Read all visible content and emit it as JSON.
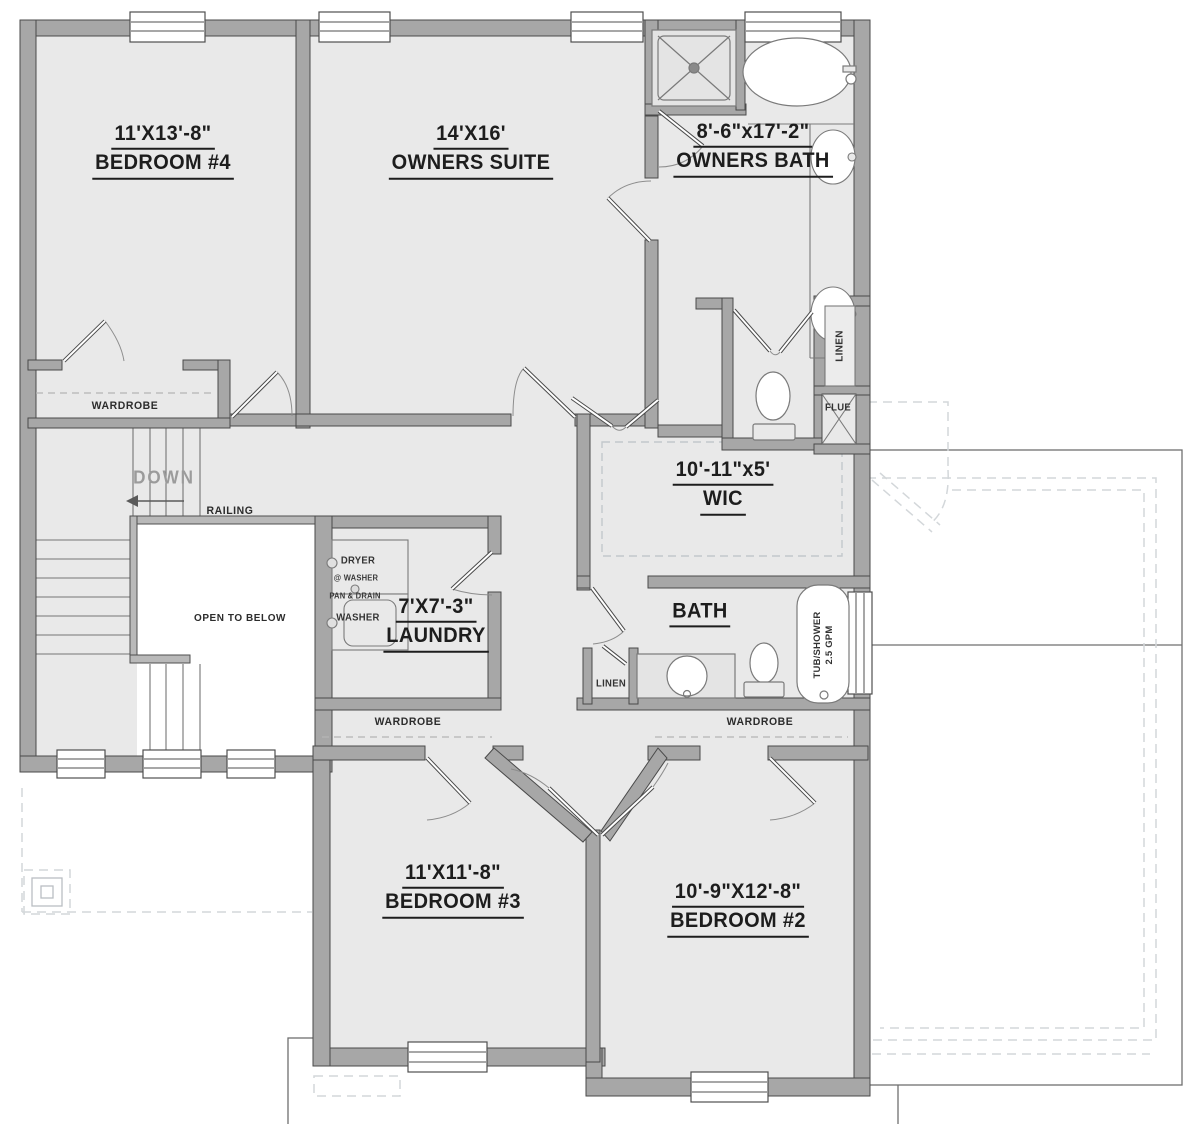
{
  "rooms": {
    "bedroom4": {
      "dims": "11'X13'-8\"",
      "name": "BEDROOM #4"
    },
    "owners_suite": {
      "dims": "14'X16'",
      "name": "OWNERS SUITE"
    },
    "owners_bath": {
      "dims": "8'-6\"x17'-2\"",
      "name": "OWNERS BATH"
    },
    "wic": {
      "dims": "10'-11\"x5'",
      "name": "WIC"
    },
    "laundry": {
      "dims": "7'X7'-3\"",
      "name": "LAUNDRY"
    },
    "bath": {
      "name": "BATH"
    },
    "bedroom3": {
      "dims": "11'X11'-8\"",
      "name": "BEDROOM #3"
    },
    "bedroom2": {
      "dims": "10'-9\"X12'-8\"",
      "name": "BEDROOM #2"
    }
  },
  "closets": {
    "wardrobe_bedroom4": "WARDROBE",
    "wardrobe_bedroom3": "WARDROBE",
    "wardrobe_bedroom2": "WARDROBE",
    "linen_hall": "LINEN",
    "linen_bath": "LINEN"
  },
  "stairwell": {
    "down": "DOWN",
    "railing": "RAILING",
    "open_to_below": "OPEN TO BELOW"
  },
  "laundry_equipment": {
    "dryer": "DRYER",
    "dryer_note": "@ WASHER",
    "pan_note": "PAN & DRAIN",
    "washer": "WASHER"
  },
  "fixtures": {
    "flue": "FLUE",
    "tub_shower": "TUB/SHOWER",
    "tub_shower_flow": "2.5 GPM"
  },
  "colors": {
    "floor": "#e9e9e9",
    "wall_fill": "#a7a7a7",
    "wall_outline": "#4a4a4a",
    "label_text": "#1d1d1d",
    "dashed_detail": "#d3d7da"
  }
}
